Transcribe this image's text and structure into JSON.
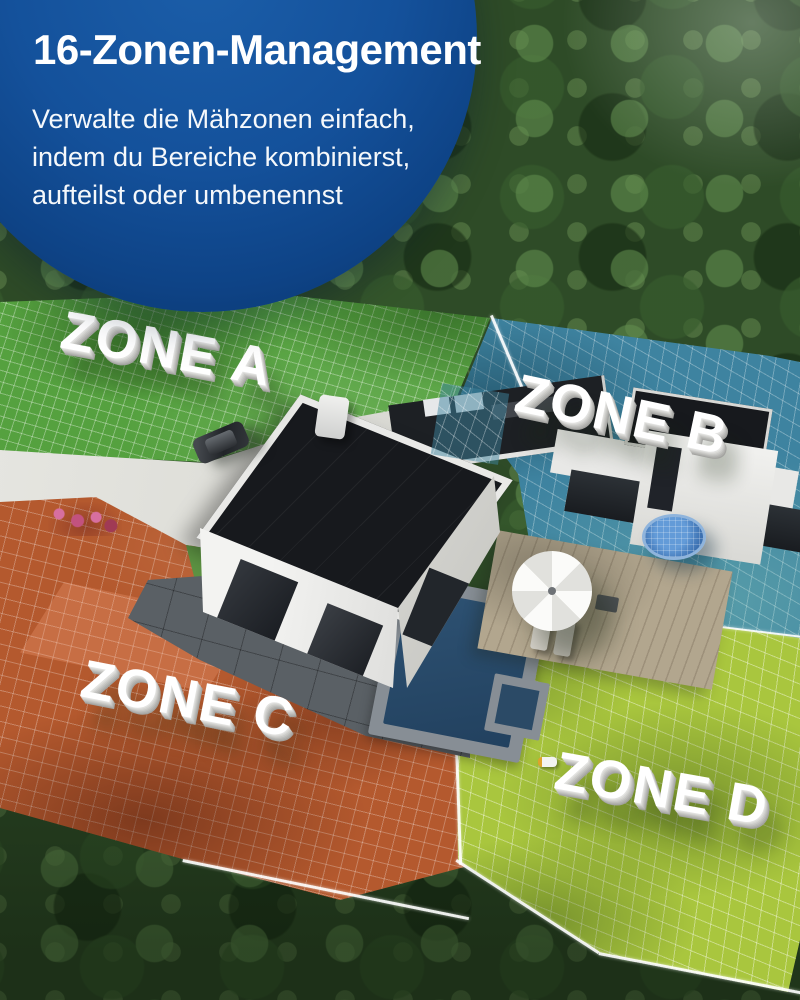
{
  "page": {
    "type": "product-feature-graphic",
    "language": "de"
  },
  "badge": {
    "title": "16-Zonen-Management",
    "lines": [
      "Verwalte die Mähzonen einfach,",
      "indem du Bereiche kombinierst,",
      "aufteilst oder umbenennst"
    ],
    "background_color": "#0f4a8f",
    "text_color": "#ffffff"
  },
  "zones": [
    {
      "id": "A",
      "label": "ZONE A",
      "overlay_color": "#55a13f"
    },
    {
      "id": "B",
      "label": "ZONE B",
      "overlay_color": "#3e83a0"
    },
    {
      "id": "C",
      "label": "ZONE C",
      "overlay_color": "#b4592e"
    },
    {
      "id": "D",
      "label": "ZONE D",
      "overlay_color": "#a9c63e"
    }
  ],
  "palette": {
    "grid_line": "#ffffff",
    "label_text": "#ffffff",
    "forest": "#2e4b27",
    "driveway": "#dcdcd6",
    "pool_water": "#2a4c6b"
  }
}
